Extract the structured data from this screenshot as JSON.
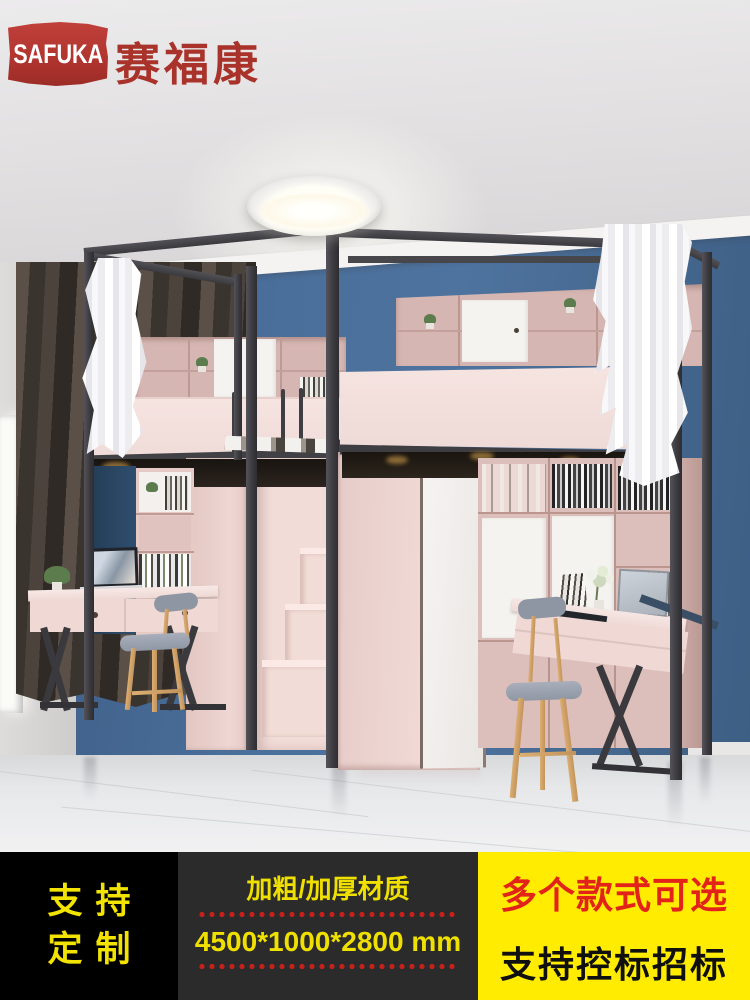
{
  "logo": {
    "brand_en": "SAFUKA",
    "brand_cn": "赛福康",
    "flag_color": "#b23530",
    "cn_text_color": "#a9322a"
  },
  "banner": {
    "custom": {
      "line1": "支持",
      "line2": "定制",
      "bg": "#000000",
      "text_color": "#f2e300"
    },
    "material": {
      "line1": "加粗/加厚材质",
      "line2": "4500*1000*2800 mm",
      "bg": "#2b2b2b",
      "text_color": "#f0e000",
      "dot_color": "#c7211b"
    },
    "styles": {
      "line1": "多个款式可选",
      "line2": "支持控标招标",
      "bg": "#ffec00",
      "line1_color": "#e2231a",
      "line2_color": "#101010"
    }
  },
  "scene": {
    "colors": {
      "wall_blue": "#4a6f9a",
      "cabinet_pink": "#d6b6b2",
      "bed_panel_pink": "#f3e1de",
      "frame_black": "#3c3b3f",
      "floor_gray": "#e8e9eb",
      "curtain_dark": "#4a423b",
      "curtain_white": "#f5f5f7"
    }
  }
}
